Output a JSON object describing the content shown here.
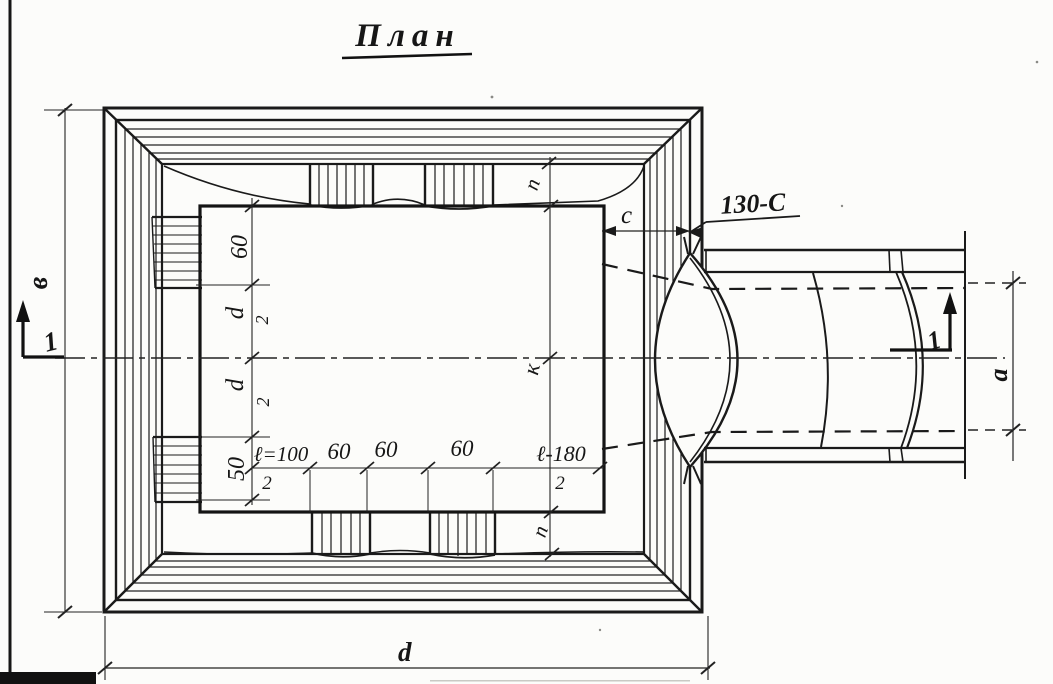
{
  "page": {
    "background": "#fcfcfa",
    "ink": "#161616"
  },
  "title": {
    "text": "План"
  },
  "section_markers": {
    "left": "1",
    "right": "1"
  },
  "callout": {
    "text": "130-C"
  },
  "dimensions": {
    "overall_height": "в",
    "overall_width": "d",
    "pipe_bore": "a",
    "wall_offset": "с",
    "edge_top": "п",
    "edge_bottom": "п",
    "center_mark": "к",
    "vertical_chain": {
      "seg1": "60",
      "seg2_num": "d",
      "seg2_den": "2",
      "seg3_num": "d",
      "seg3_den": "2",
      "seg4": "50"
    },
    "horizontal_chain": {
      "seg1_num": "ℓ=100",
      "seg1_den": "2",
      "seg2": "60",
      "seg3": "60",
      "seg4": "60",
      "seg5_num": "ℓ-180",
      "seg5_den": "2"
    }
  }
}
